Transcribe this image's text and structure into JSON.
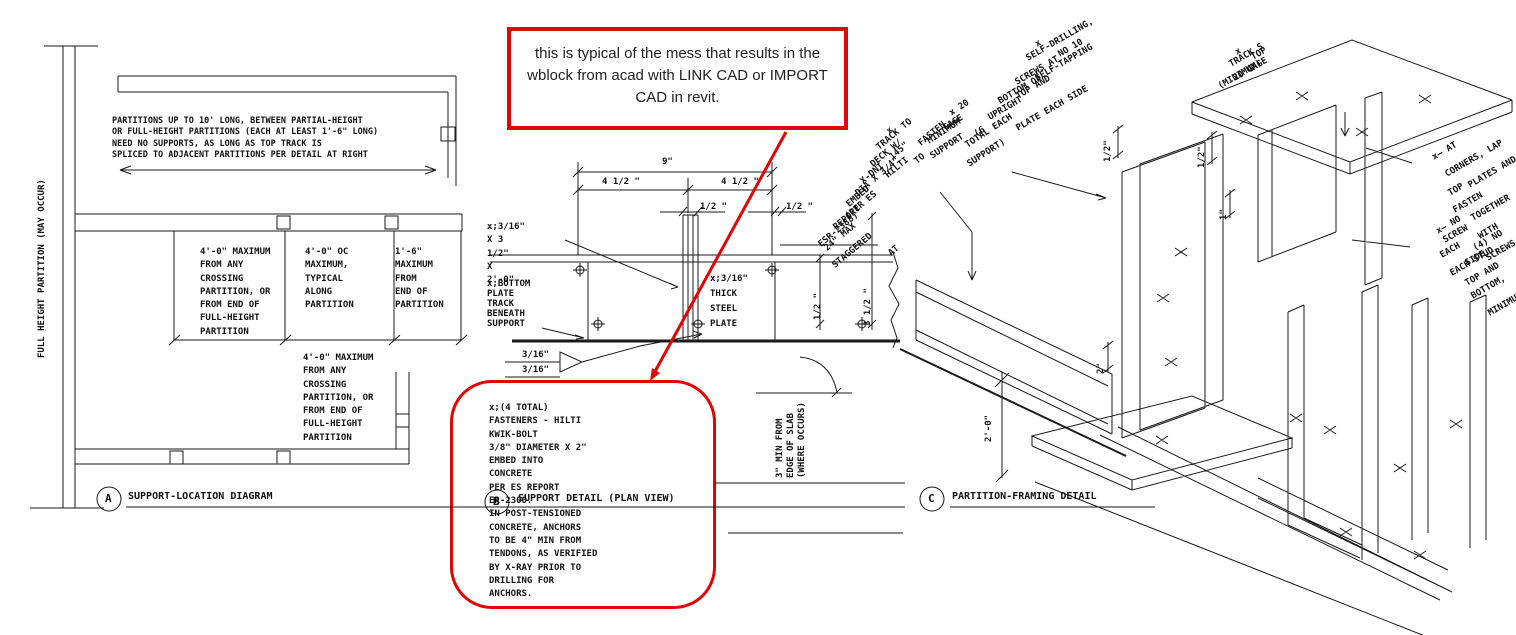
{
  "colors": {
    "red": "#e10505",
    "line": "#1a1a1a"
  },
  "callout_top": {
    "text": "this is typical of the mess that results in the\nwblock from acad with LINK CAD or IMPORT\nCAD in revit."
  },
  "view_a": {
    "bubble": "A",
    "title": "SUPPORT-LOCATION DIAGRAM",
    "wall_label": "FULL HEIGHT PARTITION (MAY OCCUR)",
    "top_note": "PARTITIONS UP TO 10' LONG, BETWEEN PARTIAL-HEIGHT\nOR FULL-HEIGHT PARTITIONS (EACH AT LEAST 1'-6\" LONG)\nNEED NO SUPPORTS, AS LONG AS TOP TRACK IS\nSPLICED TO ADJACENT PARTITIONS PER DETAIL AT RIGHT",
    "note_crossing": "4'-0\" MAXIMUM\nFROM ANY\nCROSSING\nPARTITION, OR\nFROM END OF\nFULL-HEIGHT\nPARTITION",
    "note_oc": "4'-0\" OC\nMAXIMUM,\nTYPICAL\nALONG\nPARTITION",
    "note_end": "1'-6\"\nMAXIMUM\nFROM\nEND OF\nPARTITION",
    "note_crossing2": "4'-0\" MAXIMUM\nFROM ANY\nCROSSING\nPARTITION, OR\nFROM END OF\nFULL-HEIGHT\nPARTITION"
  },
  "view_b": {
    "bubble": "B",
    "title": "SUPPORT DETAIL (PLAN VIEW)",
    "dim_overall": "9\"",
    "dim_half_l": "4 1/2 \"",
    "dim_half_r": "4 1/2 \"",
    "dim_gap_l": "1/2 \"",
    "dim_gap_r": "1/2 \"",
    "dim_side_s": "1/2 \"",
    "dim_side_l": "3 1/2 \"",
    "size_note": "x;3/16\"\nX 3\n1/2\"\nX\n2'-0\"",
    "track_note": "x;BOTTOM\nPLATE\nTRACK\nBENEATH\nSUPPORT",
    "plate_note": "x;3/16\"\nTHICK\nSTEEL\nPLATE",
    "weld_a": "3/16\"",
    "weld_b": "3/16\"",
    "slab_note": "3\" MIN FROM\nEDGE OF SLAB\n(WHERE OCCURS)",
    "fastener_lines": [
      "x",
      "FASTEN",
      "TRACK TO",
      "DECK W/",
      "HILTI",
      "X-DNI .145\"",
      "DIA X 3/4\"",
      "EMBED",
      "(PER ES",
      "REPORT",
      "ESR-2388)",
      "24\" MAX",
      "AT",
      "STAGGERED",
      "TO"
    ]
  },
  "callout_note": {
    "text": "x;(4 TOTAL)\nFASTENERS - HILTI\nKWIK-BOLT\n3/8\" DIAMETER X 2\"\nEMBED INTO\nCONCRETE\nPER ES REPORT\nER-2300.\nIN POST-TENSIONED\nCONCRETE,  ANCHORS\nTO BE 4\" MIN FROM\nTENDONS, AS VERIFIED\nBY X-RAY PRIOR TO\nDRILLING FOR\nANCHORS."
  },
  "view_c": {
    "bubble": "C",
    "title": "PARTITION-FRAMING DETAIL",
    "screw_lines": [
      "x",
      "NO 10",
      "SELF-DRILLING,",
      "SELF-TAPPING",
      "SCREWS AT",
      "TOP AND",
      "BOTTOM OF",
      "UPRIGHT",
      "PLATE EACH SIDE"
    ],
    "gage_lines": [
      "x  20",
      "GAGE",
      "(6",
      "MINIMUM",
      "TOTAL EACH",
      "SUPPORT",
      "SUPPORT)"
    ],
    "toptrack_lines": [
      "x",
      "TOP",
      "TRACK S",
      "20 GAGE",
      "(MINIMUM)"
    ],
    "corner_lines": [
      "x—   AT",
      "CORNERS, LAP",
      "TOP",
      "PLATES AND",
      "FASTEN",
      "x— NO",
      "TOGETHER",
      "SCREW",
      "WITH",
      "EACH",
      "(4) NO",
      "SIDE,",
      "SCREWS",
      "EACH STUD,",
      "TOP AND",
      "BOTTOM,",
      "MINIMUM"
    ],
    "dim_2ft": "2'-0\"",
    "dim_2": "2\"",
    "dim_1": "1\"",
    "dim_half_a": "1/2\"",
    "dim_half_b": "1/2\""
  }
}
